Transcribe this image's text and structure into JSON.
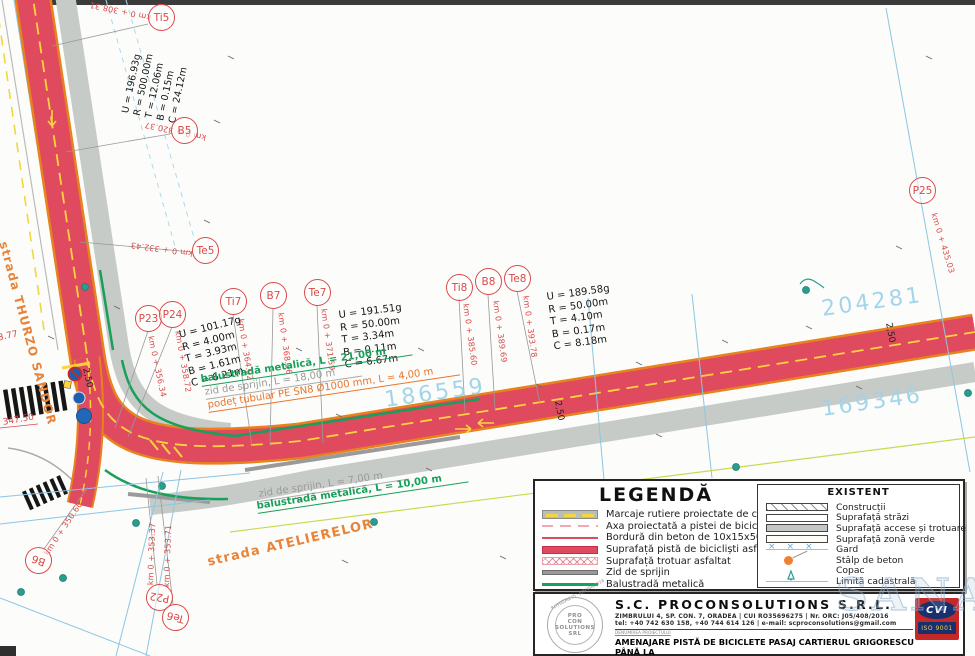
{
  "colors": {
    "bike_path": "#e04a5f",
    "curb": "#e8821c",
    "road_marking": "#ffd23f",
    "balustrade": "#18a05a",
    "retaining_wall": "#9a9a9a",
    "cadastral_line": "#8cc6e2",
    "parcel_label": "#9fd3ea",
    "station_label": "#d94a4a",
    "street_label": "#e8833a",
    "sidewalk": "#c7cbc7"
  },
  "stations": [
    {
      "id": "Ti5",
      "km": "km 0 + 308.31"
    },
    {
      "id": "B5",
      "km": "km 0 + 320.37"
    },
    {
      "id": "Te5",
      "km": "km 0 + 332.43"
    },
    {
      "id": "P23",
      "km": "km 0 + 356.34"
    },
    {
      "id": "P24",
      "km": "km 0 + 358.72"
    },
    {
      "id": "Ti7",
      "km": "km 0 + 364.92"
    },
    {
      "id": "B7",
      "km": "km 0 + 368.26"
    },
    {
      "id": "Te7",
      "km": "km 0 + 371.59"
    },
    {
      "id": "Ti8",
      "km": "km 0 + 385.60"
    },
    {
      "id": "B8",
      "km": "km 0 + 389.69"
    },
    {
      "id": "Te8",
      "km": "km 0 + 393.78"
    },
    {
      "id": "P25",
      "km": "km 0 + 435.03"
    },
    {
      "id": "B6",
      "km": "km 0 + 350.60"
    },
    {
      "id": "P22",
      "km": "km 0 + 353.37"
    },
    {
      "id": "Te6",
      "km": "km 0 + 353.71"
    }
  ],
  "curves": [
    {
      "lines": [
        "U = 196.93g",
        "R = 500.00m",
        "T = 12.06m",
        "B = 0.15m",
        "C = 24.12m"
      ]
    },
    {
      "lines": [
        "U = 101.17g",
        "R = 4.00m",
        "T = 3.93m",
        "B = 1.61m",
        "C = 6.21m"
      ]
    },
    {
      "lines": [
        "U = 191.51g",
        "R = 50.00m",
        "T = 3.34m",
        "B = 0.11m",
        "C = 6.67m"
      ]
    },
    {
      "lines": [
        "U = 189.58g",
        "R = 50.00m",
        "T = 4.10m",
        "B = 0.17m",
        "C = 8.18m"
      ]
    }
  ],
  "annotations": {
    "balustrade_21": "balustradă metalică, L = 21,00 m",
    "wall_18": "zid de sprijin, L = 18,00 m",
    "culvert": "podeț tubular PE SN8 Ø1000 mm, L = 4,00 m",
    "wall_7": "zid de sprijin, L = 7,00 m",
    "balustrade_10": "balustradă metalică, L = 10,00 m"
  },
  "streets": {
    "thurzo": "strada THURZO SANDOR",
    "ateliere": "strada ATELIERELOR"
  },
  "parcels": [
    "186559",
    "204281",
    "169346"
  ],
  "dimensions": [
    "2,50",
    "2,50",
    "2,50"
  ],
  "elevations": [
    "347.50",
    "343.77"
  ],
  "legend": {
    "title": "LEGENDĂ",
    "items": [
      {
        "label": "Marcaje rutiere proiectate de culoare albă"
      },
      {
        "label": "Axa proiectată a pistei de biciclete"
      },
      {
        "label": "Bordură din beton de 10x15x50 cm"
      },
      {
        "label": "Suprafață pistă de bicicliști asfaltată"
      },
      {
        "label": "Suprafață trotuar asfaltat"
      },
      {
        "label": "Zid de sprijin"
      },
      {
        "label": "Balustradă metalică"
      }
    ],
    "existent": {
      "title": "EXISTENT",
      "items": [
        {
          "label": "Construcții"
        },
        {
          "label": "Suprafață străzi"
        },
        {
          "label": "Suprafață accese și trotuare"
        },
        {
          "label": "Suprafață zonă verde"
        },
        {
          "label": "Gard"
        },
        {
          "label": "Stâlp de beton"
        },
        {
          "label": "Copac"
        },
        {
          "label": "Limită cadastrală"
        }
      ]
    }
  },
  "titleblock": {
    "company": "S.C. PROCONSOLUTIONS S.R.L.",
    "address": "ZIMBRULUI 4, SP. CON. 7, ORADEA | CUI RO35696275 | Nr. ORC: J05/408/2016",
    "contact": "tel: +40 742 630 158, +40 744 614 126 | e-mail: scproconsolutions@gmail.com",
    "project_label": "DENUMIREA PROIECTULUI",
    "project_title_line1": "AMENAJARE PISTĂ DE BICICLETE PASAJ CARTIERUL GRIGORESCU PÂNĂ LA",
    "project_title_line2": "PISTA EXISTENTĂ PE SEXTIL PUȘCARIU, MUNICIPIUL ORADEA, JUDEȚUL BIHOR",
    "stamp": {
      "registration": "RO35696275 - J05/408/2016",
      "line1": "PRO",
      "line2": "CON",
      "line3": "SOLUTIONS",
      "line4": "SRL"
    },
    "cert": {
      "name": "CVI",
      "iso": "ISO 9001"
    }
  },
  "watermark": "SANA"
}
